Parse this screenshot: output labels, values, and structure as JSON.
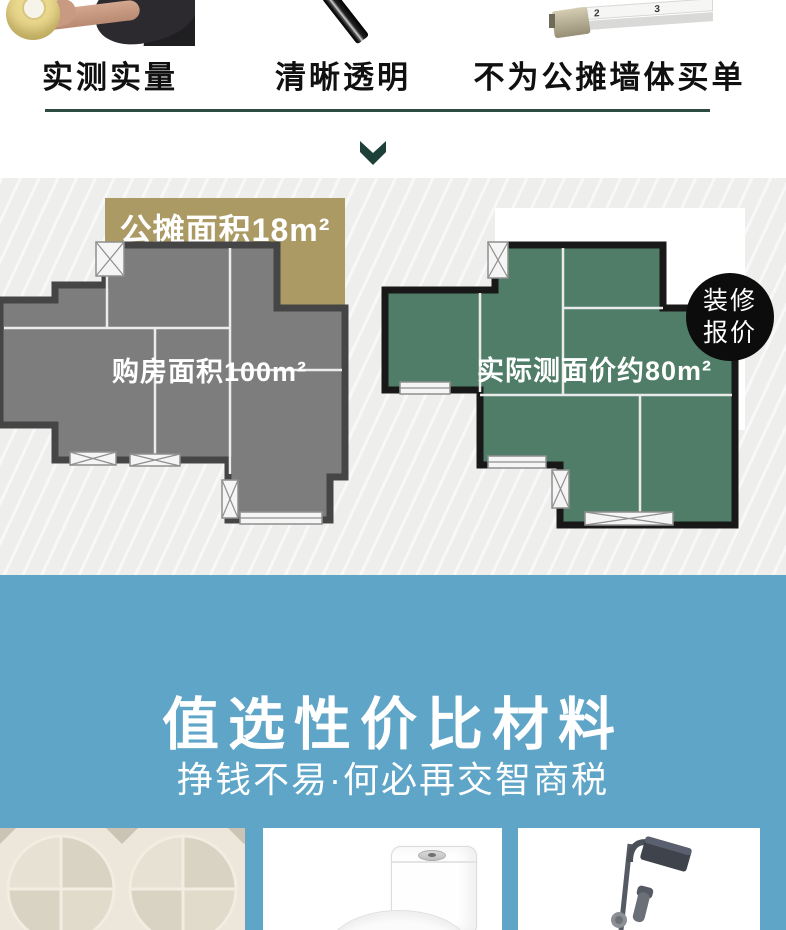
{
  "features": {
    "items": [
      {
        "label": "实测实量"
      },
      {
        "label": "清晰透明"
      },
      {
        "label": "不为公摊墙体买单"
      }
    ],
    "tape_scale_numbers": "2 3 4"
  },
  "floorplans": {
    "shared_area": {
      "label": "公摊面积18m²"
    },
    "purchased_area": {
      "label": "购房面积100m²"
    },
    "measured_area": {
      "label": "实际测面价约80m²"
    },
    "badge": {
      "line1": "装修",
      "line2": "报价"
    }
  },
  "materials": {
    "title": "值选性价比材料",
    "subtitle": "挣钱不易·何必再交智商税"
  },
  "colors": {
    "accent_dark_green": "#2b4b43",
    "section_blue": "#5fa5c7",
    "shared_area_tan": "#ab9a63",
    "plan_gray": "#7d7d7d",
    "plan_green": "#4f7d68",
    "badge_black": "#0c0c0c"
  }
}
